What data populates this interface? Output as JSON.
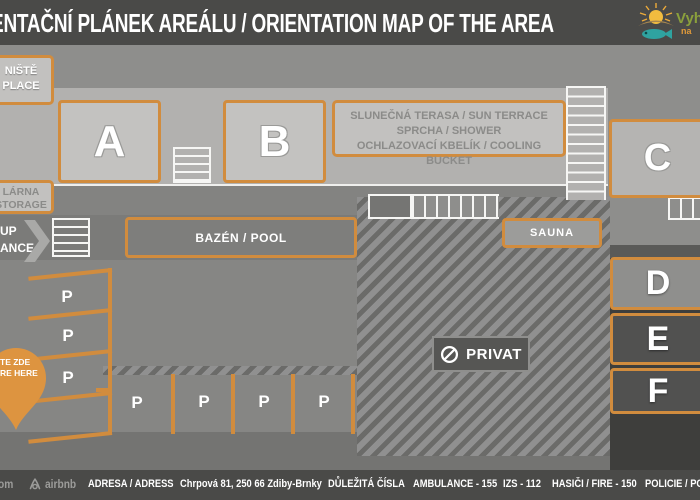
{
  "header": {
    "title": "ENTAČNÍ PLÁNEK AREÁLU / ORIENTATION MAP OF THE AREA"
  },
  "logo": {
    "line1": "Vyhl",
    "line2": "na"
  },
  "map": {
    "fireplace_label": {
      "line1": "NIŠTĚ",
      "line2": "PLACE"
    },
    "storage_label": {
      "line1": "LÁRNA",
      "line2": "STORAGE"
    },
    "entrance_label": {
      "line1": "UP",
      "line2": "ANCE"
    },
    "terrace_label": {
      "line1": "SLUNEČNÁ TERASA / SUN TERRACE",
      "line2": "SPRCHA / SHOWER",
      "line3": "OCHLAZOVACÍ KBELÍK / COOLING BUCKET"
    },
    "pool_label": "BAZÉN / POOL",
    "sauna_label": "SAUNA",
    "privat_label": "PRIVAT",
    "you_are_here": {
      "line1": "TE ZDE",
      "line2": "RE HERE"
    },
    "buildings": {
      "a": "A",
      "b": "B",
      "c": "C",
      "d": "D",
      "e": "E",
      "f": "F"
    },
    "parking_symbol": "P"
  },
  "footer": {
    "booking_fragment": "om",
    "airbnb_label": "airbnb",
    "address_label": "ADRESA / ADRESS",
    "address": "Chrpová 81, 250 66 Zdiby-Brnky",
    "numbers_label": "DŮLEŽITÁ ČÍSLA",
    "numbers": [
      "AMBULANCE - 155",
      "IZS - 112",
      "HASIČI / FIRE - 150",
      "POLICIE / POL"
    ]
  },
  "colors": {
    "accent_orange": "#d18c3e",
    "header_bg": "#4a4a48",
    "pin_orange": "#dd9440",
    "logo_green": "#8ba03c",
    "logo_orange": "#e09a3a",
    "fish_teal": "#2fa3a0"
  }
}
